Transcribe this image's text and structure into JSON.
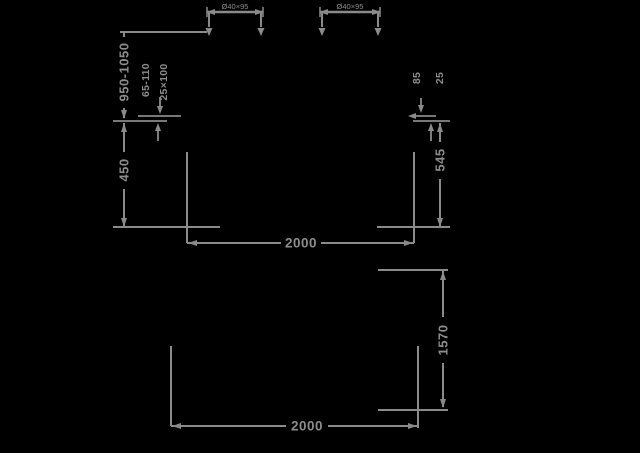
{
  "colors": {
    "background": "#000000",
    "line": "#8a8a8a",
    "text": "#8c8c8c"
  },
  "diagram": {
    "kind": "technical-dimension-drawing",
    "front_view": {
      "bracket_left_label": "Ø40×95",
      "bracket_right_label": "Ø40×95",
      "height_range": "950-1050",
      "left_offset_label": "65-110",
      "left_slot_label": "25×100",
      "lower_height": "450",
      "width": "2000",
      "right_offset_label": "85",
      "right_thickness_label": "25",
      "right_height": "545"
    },
    "top_view": {
      "depth": "1570",
      "width": "2000"
    }
  }
}
